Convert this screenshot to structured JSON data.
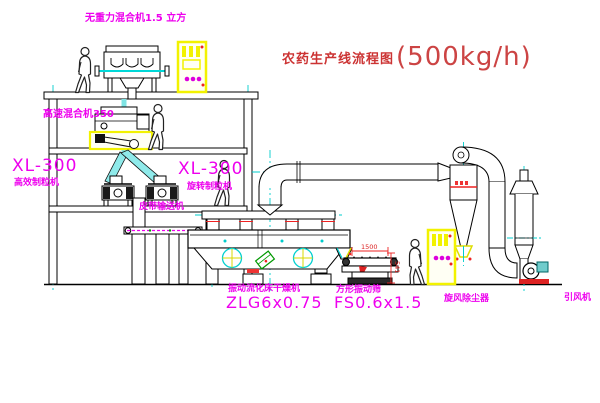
{
  "title": {
    "main": "农药生产线流程图",
    "capacity": "(500kg/h)"
  },
  "labels": {
    "gravity_mixer": "无重力混合机1.5 立方",
    "high_speed_mixer": "高速混合机350",
    "granulator_left": {
      "model": "XL-300",
      "name": "高效制粒机"
    },
    "granulator_mid": {
      "model": "XL-300",
      "name": "旋转制粒机"
    },
    "belt_conveyor": "皮带输送机",
    "fluid_bed_dryer": {
      "name": "振动流化床干燥机",
      "model": "ZLG6x0.75"
    },
    "square_sieve": {
      "name": "方形振动筛",
      "model": "FS0.6x1.5"
    },
    "cyclone": "旋风除尘器",
    "draft_fan": "引风机"
  },
  "dimensions": {
    "sieve_length": "1500",
    "sieve_height": "541"
  },
  "colors": {
    "line": "#000000",
    "centerline_cyan": "#00cccc",
    "label_magenta": "#ee00ee",
    "title_red": "#cc3333",
    "highlight_yellow": "#f2f200",
    "chute_cyan": "#8feaea",
    "accent_red": "#dd2222",
    "accent_green": "#009900"
  }
}
